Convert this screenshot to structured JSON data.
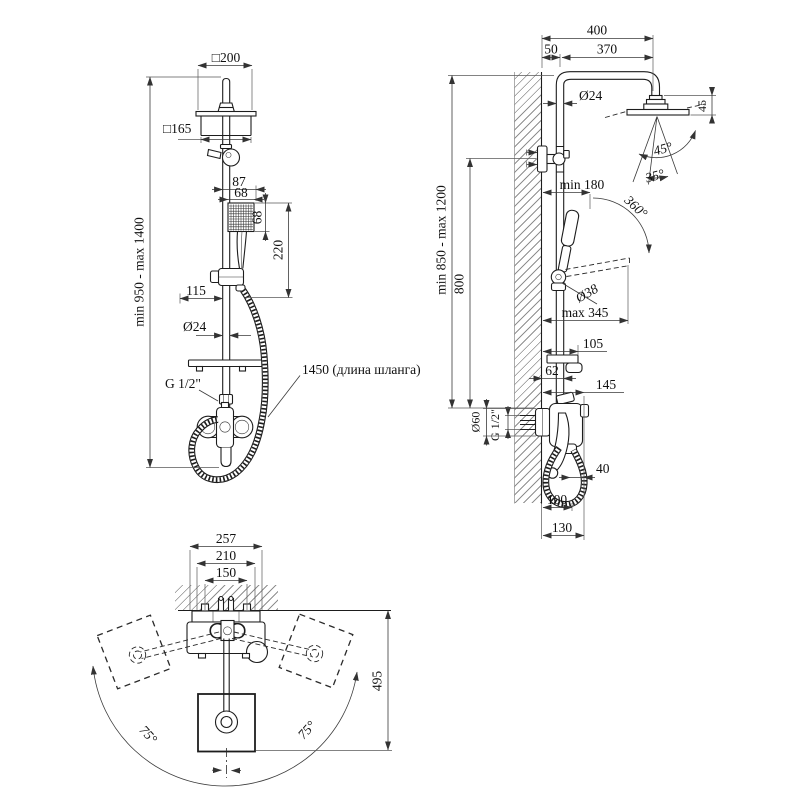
{
  "drawing": {
    "front_view": {
      "dim_head_width": "□200",
      "dim_head_body": "□165",
      "dim_87": "87",
      "dim_68_w": "68",
      "dim_68_h": "68",
      "dim_220": "220",
      "dim_115": "115",
      "dim_pipe_dia": "Ø24",
      "dim_thread": "G 1/2\"",
      "dim_height_range": "min 950 - max 1400",
      "hose_note": "1450 (длина шланга)"
    },
    "side_view": {
      "dim_400": "400",
      "dim_50": "50",
      "dim_370": "370",
      "dim_pipe_dia": "Ø24",
      "dim_head_height": "45",
      "angle_45": "45°",
      "angle_35": "35°",
      "dim_min180": "min 180",
      "angle_360": "360°",
      "dim_handle_dia": "Ø38",
      "dim_max345": "max 345",
      "dim_105": "105",
      "dim_62": "62",
      "dim_145": "145",
      "dim_supply_dia": "Ø60",
      "dim_thread": "G 1/2\"",
      "dim_40": "40",
      "dim_100": "100",
      "dim_130": "130",
      "dim_800": "800",
      "dim_height_range": "min 850 - max 1200"
    },
    "top_view": {
      "dim_257": "257",
      "dim_210": "210",
      "dim_150": "150",
      "dim_495": "495",
      "angle_left": "75°",
      "angle_right": "75°"
    }
  }
}
